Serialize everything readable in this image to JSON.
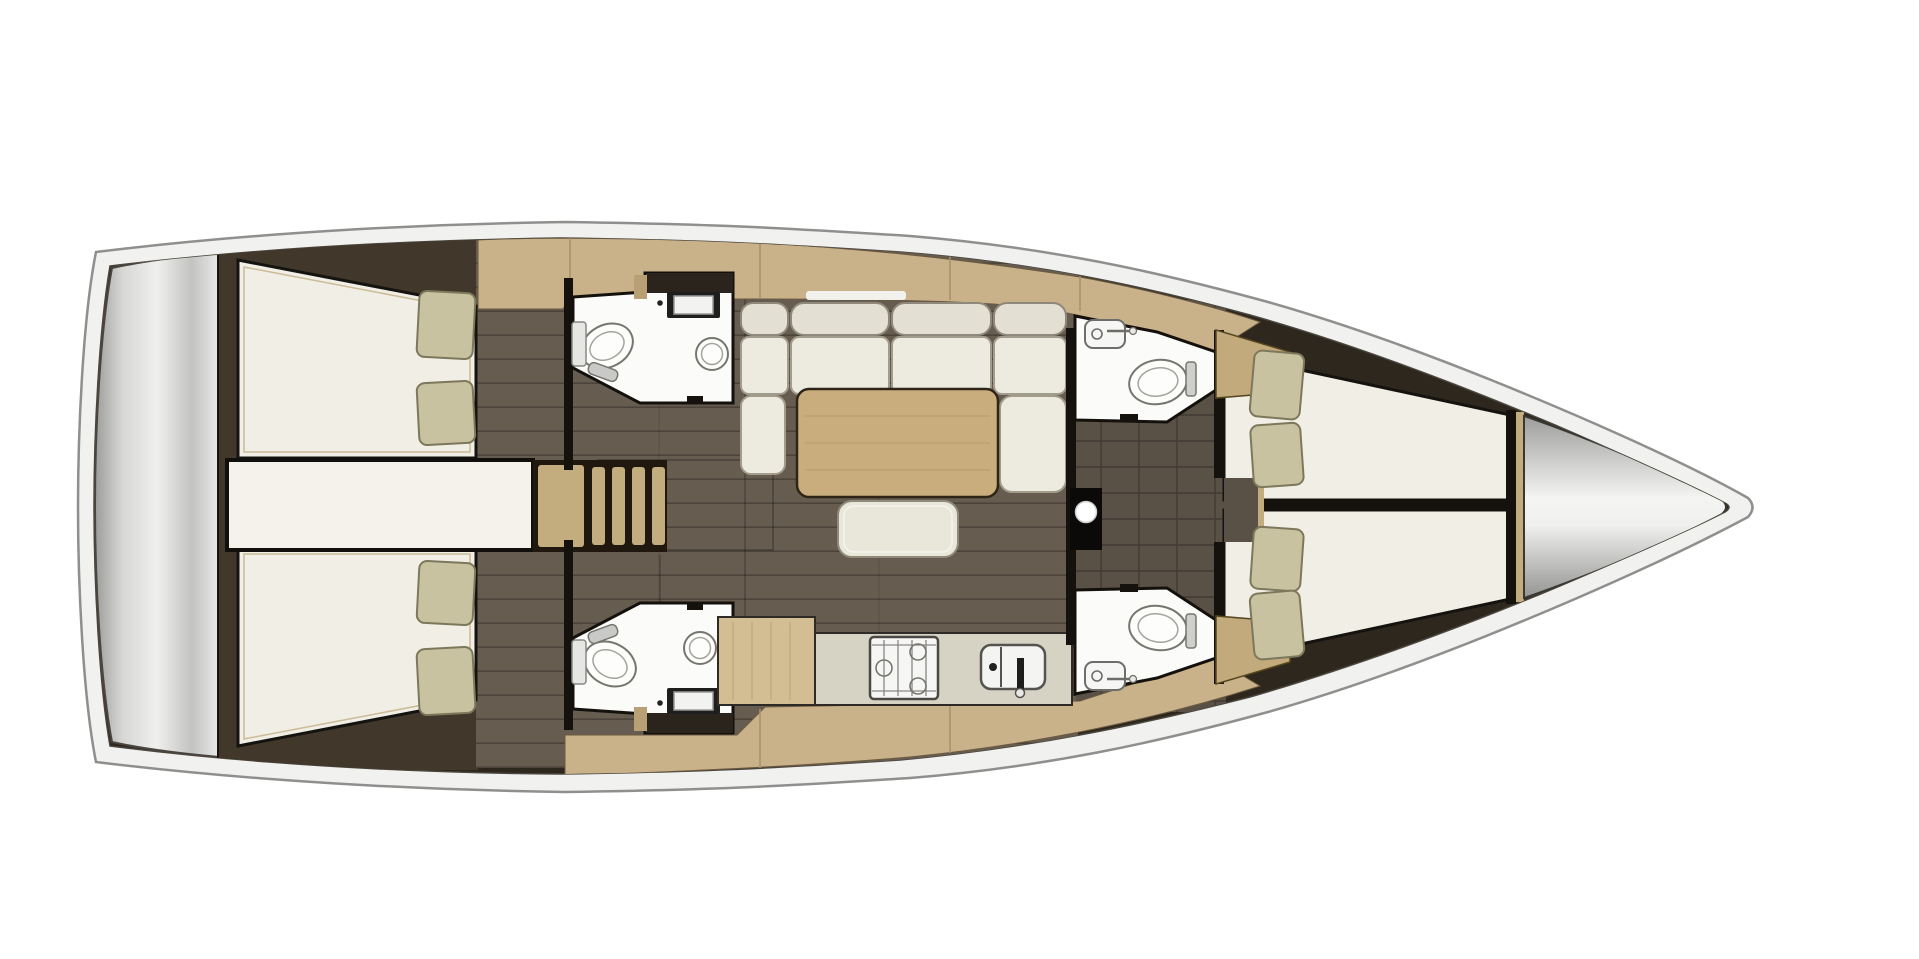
{
  "meta": {
    "type": "floor-plan",
    "subject": "Sailing yacht interior layout, overhead (top-down) view",
    "orientation": "bow to the right, stern to the left"
  },
  "palette": {
    "bg": "#ffffff",
    "hull": "#f1f1ef",
    "hull-line": "#8f8f8d",
    "interior": "#2e271e",
    "cabin-brown": "#41372a",
    "floor": "#665c50",
    "floor-dark": "#5a5146",
    "wood": "#c9b189",
    "wood-light": "#d3bd92",
    "wood-mid": "#c3ac7e",
    "bed": "#f0eee5",
    "pillow": "#c8c2a1",
    "cushion-seat": "#edeae0",
    "cushion-back": "#e3e0d3",
    "table": "#c9ad7d",
    "counter": "#d7d3c4",
    "room-white": "#fbfbf9",
    "wall": "#15110c",
    "metal-light": "#efefed",
    "metal-dark": "#9c9c9a"
  },
  "regions": {
    "hull": {
      "label": "Hull and deck outline"
    },
    "transom": {
      "label": "Stern transom / swim platform"
    },
    "aft_cabin_port": {
      "label": "Aft cabin port: double berth with two pillows",
      "pillows": 2
    },
    "aft_cabin_starboard": {
      "label": "Aft cabin starboard: double berth with two pillows",
      "pillows": 2
    },
    "engine_compartment": {
      "label": "Engine compartment between aft cabins"
    },
    "companionway": {
      "label": "Companionway ladder with steps",
      "steps": 4
    },
    "head_aft_port": {
      "label": "Aft head port: toilet, square washbasin, shower",
      "fixtures": [
        "toilet",
        "washbasin",
        "shower"
      ]
    },
    "head_aft_starboard": {
      "label": "Aft head starboard: toilet, square washbasin, shower",
      "fixtures": [
        "toilet",
        "washbasin",
        "shower"
      ]
    },
    "salon": {
      "label": "Salon with U-shaped settee",
      "back_cushions": 4,
      "seat_cushions": 4
    },
    "table": {
      "label": "Salon dining table"
    },
    "ottoman": {
      "label": "Salon ottoman bench"
    },
    "galley": {
      "label": "Galley: worktop, two-burner stove, sink with faucet",
      "fixtures": [
        "stove",
        "sink"
      ]
    },
    "corridor": {
      "label": "Central passageway with mast post"
    },
    "mast": {
      "label": "Mast post"
    },
    "head_fwd_port": {
      "label": "Forward head port: washbasin and toilet",
      "fixtures": [
        "washbasin",
        "toilet"
      ]
    },
    "head_fwd_starboard": {
      "label": "Forward head starboard: washbasin and toilet",
      "fixtures": [
        "washbasin",
        "toilet"
      ]
    },
    "fwd_cabin": {
      "label": "Forward V-berth cabin: two berths, four pillows",
      "pillows": 4
    },
    "anchor_locker": {
      "label": "Bow anchor locker"
    }
  },
  "totals": {
    "cabins": 3,
    "heads": 4,
    "pillows": 8,
    "companionway_steps": 4
  }
}
